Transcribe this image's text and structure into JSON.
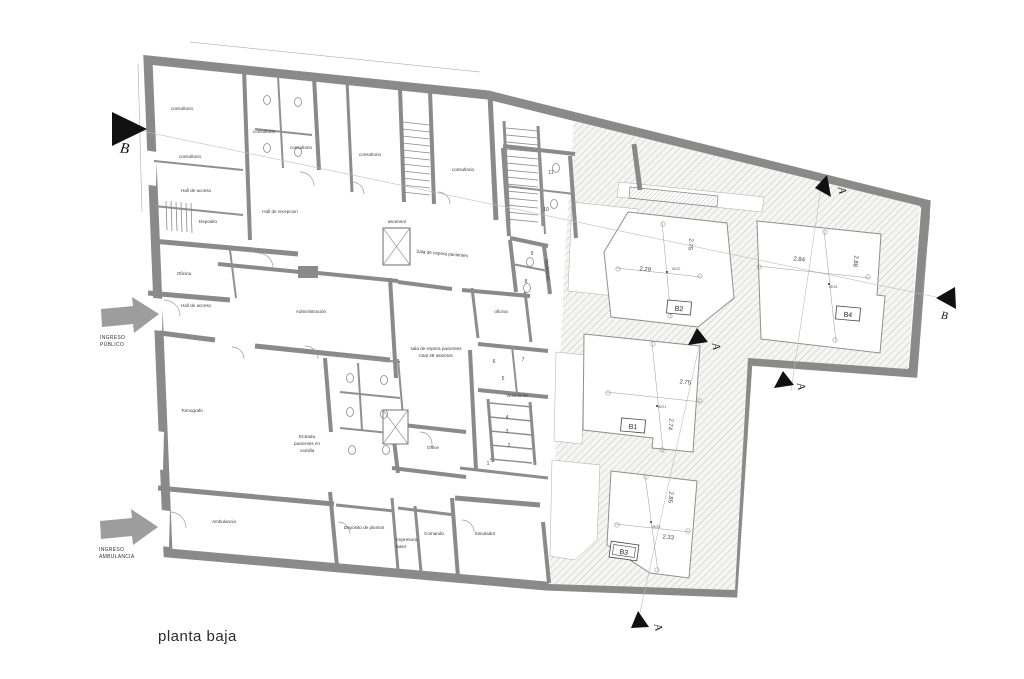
{
  "title": "planta baja",
  "colors": {
    "wall": "#8a8a8a",
    "hatch_line": "#c4c4c4",
    "hatch_bg": "#f5f5f3",
    "black": "#111111",
    "entry_arrow": "#9d9d9d"
  },
  "entries": {
    "publico_line1": "INGRESO",
    "publico_line2": "PÚBLICO",
    "ambulancia_line1": "INGRESO",
    "ambulancia_line2": "AMBULANCIA"
  },
  "rooms": {
    "consultorio": "consultorio",
    "hall_acceso": "Hall de acceso",
    "deposito": "Deposito",
    "hall_recepcion": "Hall de recepcion",
    "oficina": "Oficina",
    "oficina_small": "oficina",
    "administracion": "Administración",
    "sala_espera": "Sala de espera pacientes",
    "sala_espera_line1": "sala de espera pacientes",
    "sala_espera_line2": "total 48 asientos",
    "tomografo": "Tomografo",
    "entrada_line1": "Entrada",
    "entrada_line2": "pacientes en",
    "entrada_line3": "camilla",
    "office": "Office",
    "vestidores": "Vestidores",
    "ascensor": "ascensor",
    "ambulancia": "Ambulancia",
    "deposito_plomos": "Deposito de plomos",
    "impresora_line1": "Impresora",
    "impresora_line2": "laser",
    "comando": "Comando",
    "simulador": "Simulador"
  },
  "patios": {
    "b1": {
      "label": "B1",
      "iso": "ISO1",
      "dim_w": "2.75",
      "dim_h": "2.74"
    },
    "b2": {
      "label": "B2",
      "iso": "ISO2",
      "dim_w": "2.29",
      "dim_h": "2.75"
    },
    "b3": {
      "label": "B3",
      "iso": "ISO3",
      "dim_w": "2.33",
      "dim_h": "2.85"
    },
    "b4": {
      "label": "B4",
      "iso": "ISO4",
      "dim_w": "2.84",
      "dim_h": "2.88"
    }
  },
  "sections": {
    "a": "A",
    "b": "B"
  },
  "room_numbers": {
    "n1": "1",
    "n2": "2",
    "n3": "3",
    "n4": "4",
    "n5": "5",
    "n6": "6",
    "n7": "7",
    "n8": "8",
    "n9": "9",
    "n10": "10",
    "n11": "11"
  }
}
